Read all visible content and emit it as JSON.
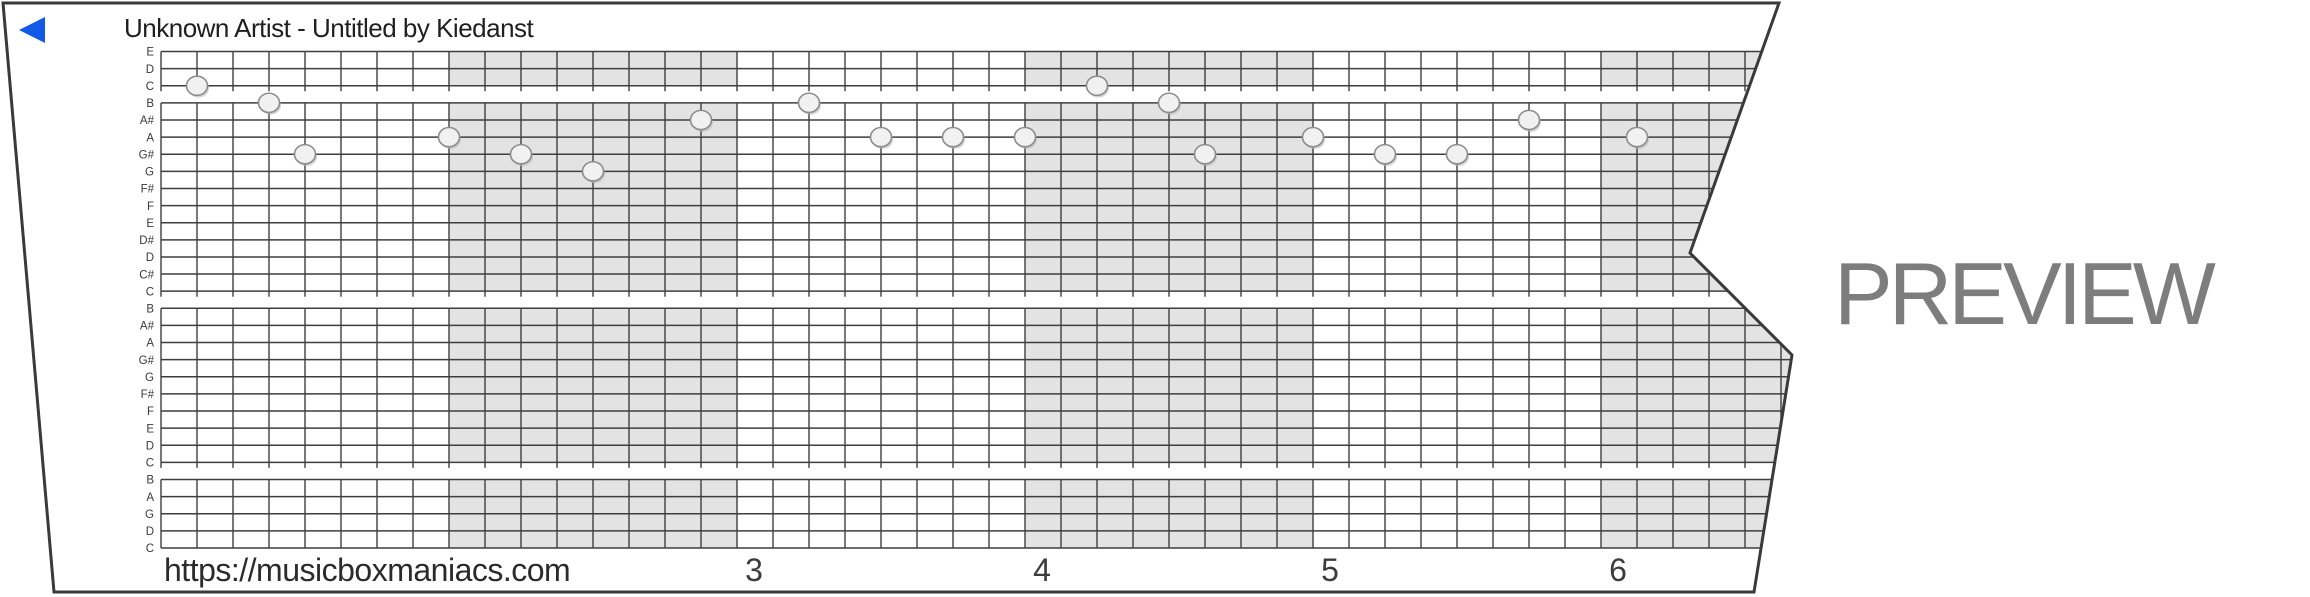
{
  "header": {
    "title": "Unknown Artist - Untitled by Kiedanst"
  },
  "footer": {
    "url": "https://musicboxmaniacs.com"
  },
  "watermark": "PREVIEW",
  "icons": {
    "play": "left-pointing-triangle"
  },
  "colors": {
    "accent_blue": "#1159e6",
    "grid_line": "#3e3e3e",
    "measure_shading": "#e3e3e3",
    "paper_border": "#3a3a3a",
    "note_fill": "#f1f1f1",
    "note_stroke": "#8c8c8c",
    "note_shadow": "#b9b9b9",
    "watermark_gray": "#7d7d7d"
  },
  "note_labels": [
    "E",
    "D",
    "C",
    "B",
    "A#",
    "A",
    "G#",
    "G",
    "F#",
    "F",
    "E",
    "D#",
    "D",
    "C#",
    "C",
    "B",
    "A#",
    "A",
    "G#",
    "G",
    "F#",
    "F",
    "E",
    "D",
    "C",
    "B",
    "A",
    "G",
    "D",
    "C"
  ],
  "measure_numbers": [
    {
      "label": "3",
      "measure_index": 2
    },
    {
      "label": "4",
      "measure_index": 3
    },
    {
      "label": "5",
      "measure_index": 4
    },
    {
      "label": "6",
      "measure_index": 5
    }
  ],
  "grid": {
    "left": 161,
    "top": 51.5,
    "row_height": 17.12,
    "beat_width": 36,
    "beats_per_measure": 8,
    "num_beats": 46,
    "octave_groups": [
      [
        0,
        2
      ],
      [
        3,
        14
      ],
      [
        15,
        24
      ],
      [
        25,
        29
      ]
    ],
    "shaded_measures": [
      1,
      3,
      5
    ],
    "c_line_stub": 5.5,
    "number_offset": 17,
    "number_baseline_y": 581,
    "right_extent": 1800
  },
  "paper": {
    "outline": [
      [
        3,
        3
      ],
      [
        1779,
        3
      ],
      [
        1690,
        253
      ],
      [
        1792,
        355
      ],
      [
        1754,
        592
      ],
      [
        54,
        592
      ]
    ]
  },
  "play_icon_points": "45,17 45,43 19,30",
  "title_pos": {
    "x": 124,
    "y": 37
  },
  "url_pos": {
    "x": 164,
    "y": 581
  },
  "notes": [
    {
      "beat": 1,
      "line": 2,
      "pitch": "C"
    },
    {
      "beat": 3,
      "line": 3,
      "pitch": "B"
    },
    {
      "beat": 4,
      "line": 6,
      "pitch": "G#"
    },
    {
      "beat": 8,
      "line": 5,
      "pitch": "A"
    },
    {
      "beat": 10,
      "line": 6,
      "pitch": "G#"
    },
    {
      "beat": 12,
      "line": 7,
      "pitch": "G"
    },
    {
      "beat": 15,
      "line": 4,
      "pitch": "A#"
    },
    {
      "beat": 18,
      "line": 3,
      "pitch": "B"
    },
    {
      "beat": 20,
      "line": 5,
      "pitch": "A"
    },
    {
      "beat": 22,
      "line": 5,
      "pitch": "A"
    },
    {
      "beat": 24,
      "line": 5,
      "pitch": "A"
    },
    {
      "beat": 26,
      "line": 2,
      "pitch": "C"
    },
    {
      "beat": 28,
      "line": 3,
      "pitch": "B"
    },
    {
      "beat": 29,
      "line": 6,
      "pitch": "G#"
    },
    {
      "beat": 32,
      "line": 5,
      "pitch": "A"
    },
    {
      "beat": 34,
      "line": 6,
      "pitch": "G#"
    },
    {
      "beat": 36,
      "line": 6,
      "pitch": "G#"
    },
    {
      "beat": 38,
      "line": 4,
      "pitch": "A#"
    },
    {
      "beat": 41,
      "line": 5,
      "pitch": "A"
    }
  ]
}
